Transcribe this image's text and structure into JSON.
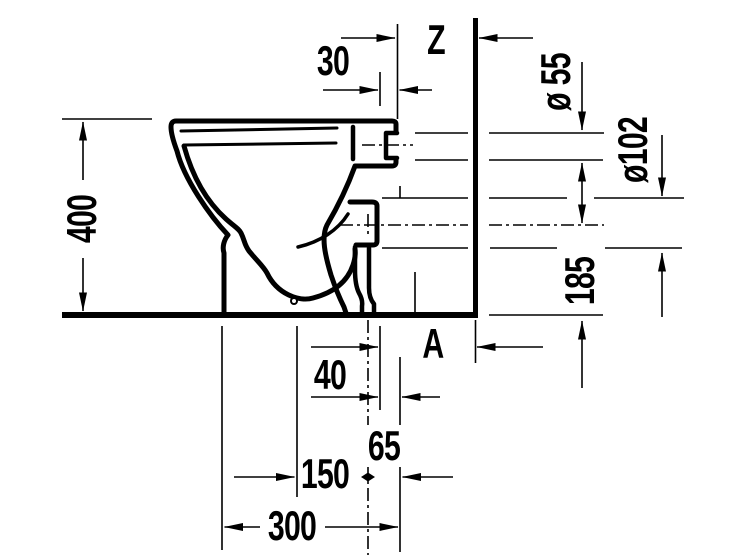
{
  "drawing_title": "toilet-side-elevation-technical-drawing",
  "colors": {
    "ink": "#000000",
    "paper": "#ffffff"
  },
  "dims": {
    "d400": "400",
    "d30": "30",
    "z": "Z",
    "dia55": "ø 55",
    "dia102": "ø102",
    "d185": "185",
    "a": "A",
    "d40": "40",
    "d65": "65",
    "d150": "150",
    "d300": "300"
  }
}
